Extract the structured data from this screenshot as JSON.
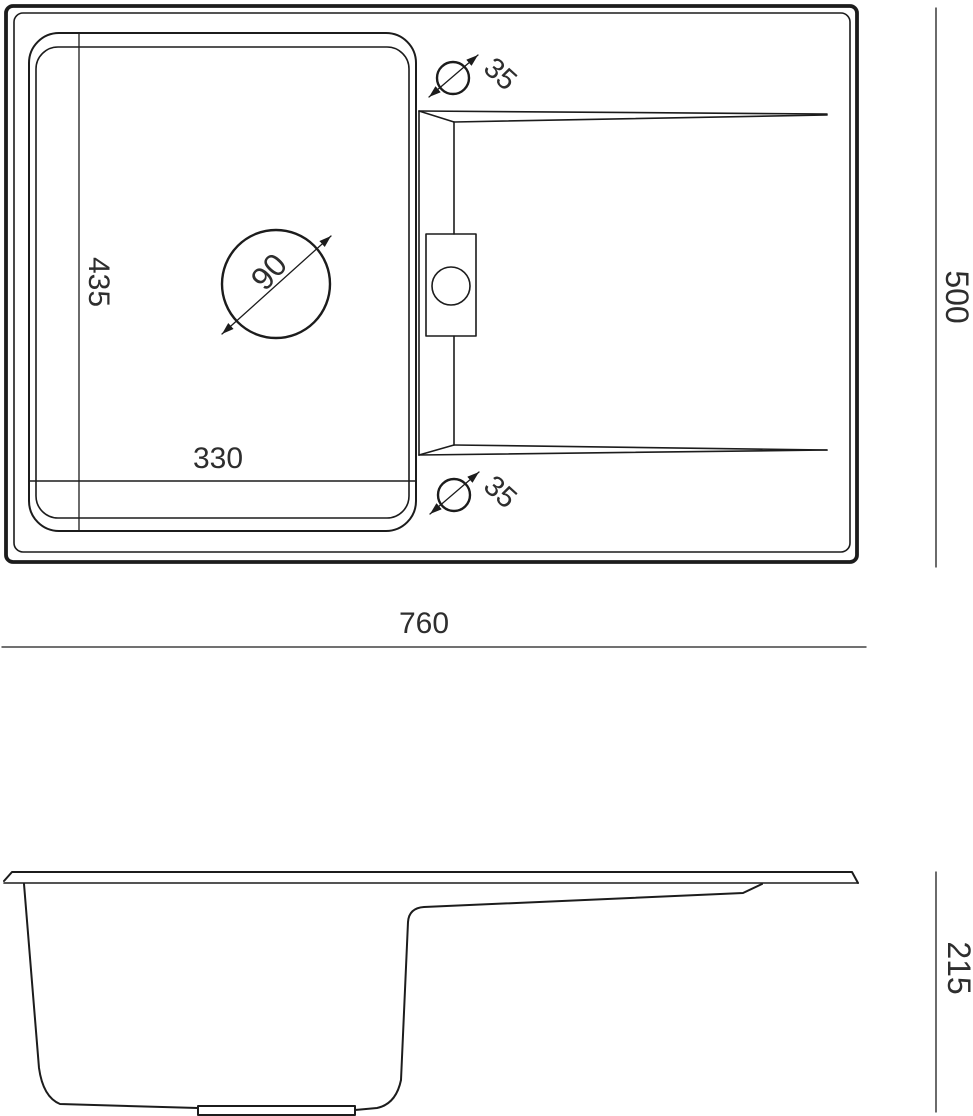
{
  "title": "Kitchen sink dimension drawing",
  "colors": {
    "line": "#1c1c1c",
    "text": "#2e2e2e",
    "background": "#ffffff"
  },
  "top_view": {
    "overall_width": "760",
    "overall_depth": "500",
    "bowl_width": "330",
    "bowl_depth": "435",
    "drain_diameter": "90",
    "tap_hole_top_diameter": "35",
    "tap_hole_bottom_diameter": "35"
  },
  "side_view": {
    "height": "215"
  }
}
